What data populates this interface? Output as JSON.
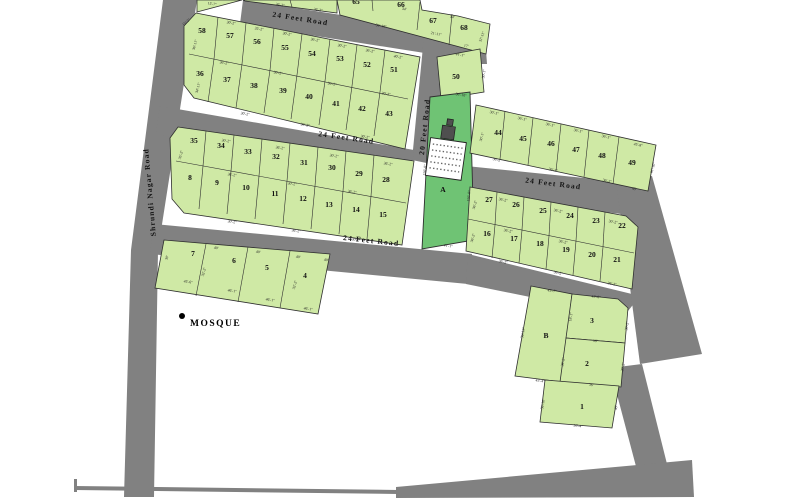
{
  "title": "Residential plot layout site plan",
  "colors": {
    "background": "#ffffff",
    "plot_fill": "#cfe9a5",
    "plot_a_fill": "#6fc374",
    "road_fill": "#818181",
    "outline": "#2f2f2f",
    "text": "#1a1a1a"
  },
  "landmarks": {
    "mosque_label": "MOSQUE"
  },
  "roads": {
    "labels": [
      {
        "text": "24 Feet Road",
        "x": 300,
        "y": 21,
        "rotate": 9
      },
      {
        "text": "24 Feet Road",
        "x": 346,
        "y": 140,
        "rotate": 8
      },
      {
        "text": "24 Feet Road",
        "x": 553,
        "y": 186,
        "rotate": 7
      },
      {
        "text": "24 Feet Road",
        "x": 371,
        "y": 243,
        "rotate": 6
      },
      {
        "text": "20 Feet Road",
        "x": 427,
        "y": 127,
        "rotate": -84
      },
      {
        "text": "Shrundi Nagar Road",
        "x": 152,
        "y": 192,
        "rotate": -95
      }
    ]
  },
  "plots": {
    "numbers": [
      {
        "t": "58",
        "x": 202,
        "y": 33
      },
      {
        "t": "57",
        "x": 230,
        "y": 38
      },
      {
        "t": "56",
        "x": 257,
        "y": 44
      },
      {
        "t": "55",
        "x": 285,
        "y": 50
      },
      {
        "t": "54",
        "x": 312,
        "y": 56
      },
      {
        "t": "53",
        "x": 340,
        "y": 61
      },
      {
        "t": "52",
        "x": 367,
        "y": 67
      },
      {
        "t": "51",
        "x": 394,
        "y": 72
      },
      {
        "t": "36",
        "x": 200,
        "y": 76
      },
      {
        "t": "37",
        "x": 227,
        "y": 82
      },
      {
        "t": "38",
        "x": 254,
        "y": 88
      },
      {
        "t": "39",
        "x": 283,
        "y": 93
      },
      {
        "t": "40",
        "x": 309,
        "y": 99
      },
      {
        "t": "41",
        "x": 336,
        "y": 106
      },
      {
        "t": "42",
        "x": 362,
        "y": 111
      },
      {
        "t": "43",
        "x": 389,
        "y": 116
      },
      {
        "t": "35",
        "x": 194,
        "y": 143
      },
      {
        "t": "34",
        "x": 221,
        "y": 148
      },
      {
        "t": "33",
        "x": 248,
        "y": 154
      },
      {
        "t": "32",
        "x": 276,
        "y": 159
      },
      {
        "t": "31",
        "x": 304,
        "y": 165
      },
      {
        "t": "30",
        "x": 332,
        "y": 170
      },
      {
        "t": "29",
        "x": 359,
        "y": 176
      },
      {
        "t": "28",
        "x": 386,
        "y": 182
      },
      {
        "t": "8",
        "x": 190,
        "y": 180
      },
      {
        "t": "9",
        "x": 217,
        "y": 185
      },
      {
        "t": "10",
        "x": 246,
        "y": 190
      },
      {
        "t": "11",
        "x": 275,
        "y": 196
      },
      {
        "t": "12",
        "x": 303,
        "y": 201
      },
      {
        "t": "13",
        "x": 329,
        "y": 207
      },
      {
        "t": "14",
        "x": 356,
        "y": 212
      },
      {
        "t": "15",
        "x": 383,
        "y": 217
      },
      {
        "t": "7",
        "x": 193,
        "y": 256
      },
      {
        "t": "6",
        "x": 234,
        "y": 263
      },
      {
        "t": "5",
        "x": 267,
        "y": 270
      },
      {
        "t": "4",
        "x": 305,
        "y": 278
      },
      {
        "t": "65",
        "x": 356,
        "y": 4
      },
      {
        "t": "66",
        "x": 401,
        "y": 7
      },
      {
        "t": "67",
        "x": 433,
        "y": 23
      },
      {
        "t": "68",
        "x": 464,
        "y": 30
      },
      {
        "t": "50",
        "x": 456,
        "y": 79
      },
      {
        "t": "A",
        "x": 443,
        "y": 192
      },
      {
        "t": "44",
        "x": 498,
        "y": 135
      },
      {
        "t": "45",
        "x": 523,
        "y": 141
      },
      {
        "t": "46",
        "x": 551,
        "y": 146
      },
      {
        "t": "47",
        "x": 576,
        "y": 152
      },
      {
        "t": "48",
        "x": 602,
        "y": 158
      },
      {
        "t": "49",
        "x": 632,
        "y": 165
      },
      {
        "t": "27",
        "x": 489,
        "y": 202
      },
      {
        "t": "26",
        "x": 516,
        "y": 207
      },
      {
        "t": "25",
        "x": 543,
        "y": 213
      },
      {
        "t": "24",
        "x": 570,
        "y": 218
      },
      {
        "t": "23",
        "x": 596,
        "y": 223
      },
      {
        "t": "22",
        "x": 622,
        "y": 228
      },
      {
        "t": "16",
        "x": 487,
        "y": 236
      },
      {
        "t": "17",
        "x": 514,
        "y": 241
      },
      {
        "t": "18",
        "x": 540,
        "y": 246
      },
      {
        "t": "19",
        "x": 566,
        "y": 252
      },
      {
        "t": "20",
        "x": 592,
        "y": 257
      },
      {
        "t": "21",
        "x": 617,
        "y": 262
      },
      {
        "t": "B",
        "x": 546,
        "y": 338
      },
      {
        "t": "3",
        "x": 592,
        "y": 323
      },
      {
        "t": "2",
        "x": 587,
        "y": 366
      },
      {
        "t": "1",
        "x": 582,
        "y": 409
      }
    ]
  },
  "dimensions": [
    {
      "t": "15'-7\"",
      "x": 212,
      "y": 5,
      "r": 9
    },
    {
      "t": "36'-2\"",
      "x": 280,
      "y": 6,
      "r": 9
    },
    {
      "t": "36'-2\"",
      "x": 318,
      "y": 11,
      "r": 9
    },
    {
      "t": "30'-2\"",
      "x": 231,
      "y": 24,
      "r": 10
    },
    {
      "t": "35'-2\"",
      "x": 259,
      "y": 30,
      "r": 10
    },
    {
      "t": "30'-2\"",
      "x": 287,
      "y": 35,
      "r": 10
    },
    {
      "t": "36'-2\"",
      "x": 315,
      "y": 41,
      "r": 10
    },
    {
      "t": "30'-2\"",
      "x": 342,
      "y": 47,
      "r": 10
    },
    {
      "t": "36'-2\"",
      "x": 370,
      "y": 52,
      "r": 10
    },
    {
      "t": "40'-2\"",
      "x": 398,
      "y": 58,
      "r": 10
    },
    {
      "t": "15'-2\"",
      "x": 187,
      "y": 23,
      "r": -40
    },
    {
      "t": "36'-11\"",
      "x": 196,
      "y": 45,
      "r": -75
    },
    {
      "t": "34'-11\"",
      "x": 199,
      "y": 88,
      "r": -75
    },
    {
      "t": "36'-2\"",
      "x": 224,
      "y": 64,
      "r": 10
    },
    {
      "t": "30'-2\"",
      "x": 278,
      "y": 74,
      "r": 10
    },
    {
      "t": "36'-2\"",
      "x": 332,
      "y": 85,
      "r": 10
    },
    {
      "t": "30'-2\"",
      "x": 386,
      "y": 95,
      "r": 10
    },
    {
      "t": "30'-2\"",
      "x": 245,
      "y": 115,
      "r": 10
    },
    {
      "t": "36'-2\"",
      "x": 305,
      "y": 126,
      "r": 10
    },
    {
      "t": "30'-2\"",
      "x": 365,
      "y": 138,
      "r": 10
    },
    {
      "t": "30'-2\"",
      "x": 226,
      "y": 142,
      "r": 9
    },
    {
      "t": "36'-2\"",
      "x": 280,
      "y": 149,
      "r": 9
    },
    {
      "t": "30'-2\"",
      "x": 334,
      "y": 157,
      "r": 9
    },
    {
      "t": "36'-2\"",
      "x": 388,
      "y": 165,
      "r": 9
    },
    {
      "t": "35'-2\"",
      "x": 182,
      "y": 155,
      "r": -75
    },
    {
      "t": "36'-2\"",
      "x": 232,
      "y": 176,
      "r": 9
    },
    {
      "t": "30'-2\"",
      "x": 292,
      "y": 185,
      "r": 9
    },
    {
      "t": "36'-2\"",
      "x": 352,
      "y": 193,
      "r": 9
    },
    {
      "t": "30'-2\"",
      "x": 232,
      "y": 223,
      "r": 9
    },
    {
      "t": "36'-2\"",
      "x": 296,
      "y": 232,
      "r": 9
    },
    {
      "t": "30'-2\"",
      "x": 356,
      "y": 241,
      "r": 9
    },
    {
      "t": "40'",
      "x": 216,
      "y": 249,
      "r": 7
    },
    {
      "t": "40'",
      "x": 258,
      "y": 253,
      "r": 7
    },
    {
      "t": "40'",
      "x": 298,
      "y": 258,
      "r": 7
    },
    {
      "t": "40'",
      "x": 326,
      "y": 261,
      "r": 7
    },
    {
      "t": "45'-6\"",
      "x": 188,
      "y": 283,
      "r": 9
    },
    {
      "t": "46'-1\"",
      "x": 232,
      "y": 292,
      "r": 9
    },
    {
      "t": "46'-1\"",
      "x": 270,
      "y": 301,
      "r": 9
    },
    {
      "t": "46'-1\"",
      "x": 308,
      "y": 310,
      "r": 9
    },
    {
      "t": "32'-2\"",
      "x": 205,
      "y": 272,
      "r": -75
    },
    {
      "t": "32'-2\"",
      "x": 296,
      "y": 285,
      "r": -75
    },
    {
      "t": "30'",
      "x": 168,
      "y": 258,
      "r": -75
    },
    {
      "t": "36'-10\"",
      "x": 381,
      "y": 27,
      "r": 10
    },
    {
      "t": "34'",
      "x": 404,
      "y": 10,
      "r": 10
    },
    {
      "t": "34'",
      "x": 452,
      "y": 18,
      "r": 10
    },
    {
      "t": "21'-11\"",
      "x": 436,
      "y": 35,
      "r": 10
    },
    {
      "t": "17'",
      "x": 466,
      "y": 47,
      "r": 10
    },
    {
      "t": "31'-11\"",
      "x": 483,
      "y": 37,
      "r": -70
    },
    {
      "t": "41'-1\"",
      "x": 460,
      "y": 56,
      "r": 10
    },
    {
      "t": "36'-10\"",
      "x": 461,
      "y": 96,
      "r": 10
    },
    {
      "t": "30'-1\"",
      "x": 485,
      "y": 74,
      "r": -80
    },
    {
      "t": "150'-0\"",
      "x": 426,
      "y": 170,
      "r": -85
    },
    {
      "t": "150'-0\"",
      "x": 470,
      "y": 196,
      "r": -85
    },
    {
      "t": "41'-1\"",
      "x": 448,
      "y": 247,
      "r": 9
    },
    {
      "t": "30'-1\"",
      "x": 494,
      "y": 114,
      "r": 12
    },
    {
      "t": "36'-1\"",
      "x": 522,
      "y": 120,
      "r": 12
    },
    {
      "t": "36'-1\"",
      "x": 550,
      "y": 126,
      "r": 12
    },
    {
      "t": "36'-1\"",
      "x": 578,
      "y": 132,
      "r": 12
    },
    {
      "t": "36'-1\"",
      "x": 606,
      "y": 138,
      "r": 12
    },
    {
      "t": "45'-8\"",
      "x": 638,
      "y": 146,
      "r": 12
    },
    {
      "t": "36'-2\"",
      "x": 497,
      "y": 161,
      "r": 12
    },
    {
      "t": "36'-2\"",
      "x": 553,
      "y": 171,
      "r": 12
    },
    {
      "t": "36'-2\"",
      "x": 607,
      "y": 182,
      "r": 12
    },
    {
      "t": "45'",
      "x": 634,
      "y": 190,
      "r": 12
    },
    {
      "t": "61'-10\"",
      "x": 654,
      "y": 168,
      "r": -72
    },
    {
      "t": "30'-1\"",
      "x": 483,
      "y": 137,
      "r": -75
    },
    {
      "t": "36'-2\"",
      "x": 503,
      "y": 201,
      "r": 11
    },
    {
      "t": "36'-2\"",
      "x": 558,
      "y": 212,
      "r": 11
    },
    {
      "t": "30'-2\"",
      "x": 613,
      "y": 223,
      "r": 11
    },
    {
      "t": "36'-2\"",
      "x": 508,
      "y": 232,
      "r": 11
    },
    {
      "t": "36'-2\"",
      "x": 563,
      "y": 243,
      "r": 11
    },
    {
      "t": "36'-2\"",
      "x": 503,
      "y": 263,
      "r": 11
    },
    {
      "t": "36'-2\"",
      "x": 558,
      "y": 274,
      "r": 11
    },
    {
      "t": "36'-2\"",
      "x": 612,
      "y": 285,
      "r": 11
    },
    {
      "t": "36'-2\"",
      "x": 476,
      "y": 205,
      "r": -75
    },
    {
      "t": "36'-2\"",
      "x": 474,
      "y": 238,
      "r": -75
    },
    {
      "t": "43'-7\"",
      "x": 552,
      "y": 292,
      "r": 8
    },
    {
      "t": "36'-11\"",
      "x": 524,
      "y": 333,
      "r": -80
    },
    {
      "t": "45'-4\"",
      "x": 540,
      "y": 382,
      "r": 8
    },
    {
      "t": "45'-8\"",
      "x": 596,
      "y": 298,
      "r": 8
    },
    {
      "t": "36'",
      "x": 595,
      "y": 342,
      "r": 7
    },
    {
      "t": "30'-2\"",
      "x": 628,
      "y": 326,
      "r": -80
    },
    {
      "t": "18'-1\"",
      "x": 572,
      "y": 317,
      "r": -80
    },
    {
      "t": "36'",
      "x": 591,
      "y": 386,
      "r": 7
    },
    {
      "t": "30'-2\"",
      "x": 624,
      "y": 367,
      "r": -80
    },
    {
      "t": "36'-2\"",
      "x": 564,
      "y": 362,
      "r": -80
    },
    {
      "t": "36'-4\"",
      "x": 578,
      "y": 427,
      "r": 8
    },
    {
      "t": "45'",
      "x": 617,
      "y": 408,
      "r": -80
    },
    {
      "t": "36'-10\"",
      "x": 544,
      "y": 404,
      "r": -80
    }
  ]
}
